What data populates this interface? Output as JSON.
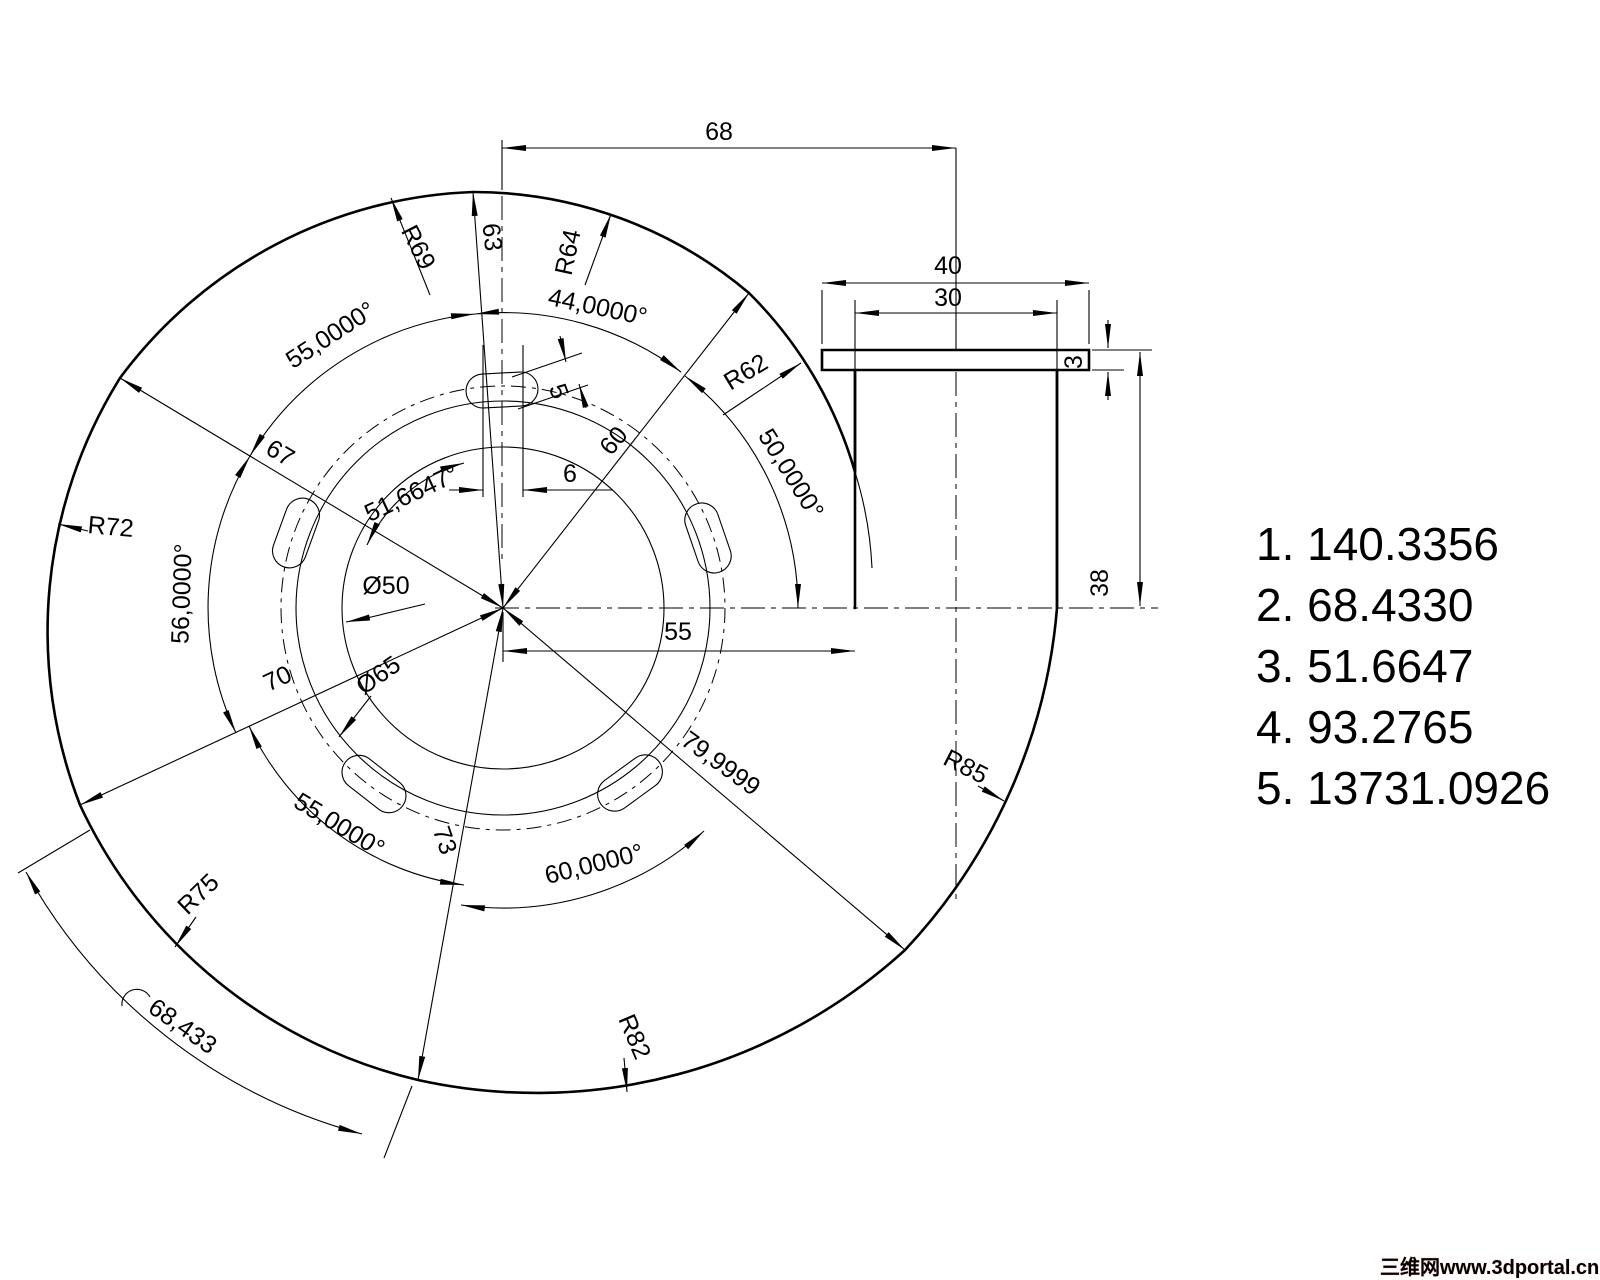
{
  "drawing_labels": {
    "radial": {
      "r63": "63",
      "r67": "67",
      "r60": "60",
      "r70": "70",
      "r73": "73",
      "r79": "79,9999",
      "arc68": "68,433"
    },
    "angles": {
      "top_left_55": "55,0000°",
      "top_44": "44,0000°",
      "top_right_50": "50,0000°",
      "left_56": "56,0000°",
      "inner_51": "51,6647°",
      "bottom_left_55": "55,0000°",
      "bottom_60": "60,0000°"
    },
    "radii": {
      "r69": "R69",
      "r64": "R64",
      "r62": "R62",
      "r72": "R72",
      "r75": "R75",
      "r82": "R82",
      "r85": "R85"
    },
    "diameters": {
      "d50": "Ø50",
      "d65": "Ø65"
    },
    "side_view": {
      "w68": "68",
      "w40": "40",
      "w30": "30",
      "t3": "3",
      "h38": "38",
      "c55": "55"
    },
    "slot": {
      "w6": "6",
      "h5": "5"
    }
  },
  "answers": {
    "items": [
      "1. 140.3356",
      "2. 68.4330",
      "3. 51.6647",
      "4. 93.2765",
      "5. 13731.0926"
    ]
  },
  "watermark": {
    "text": "三维网www.3dportal.cn",
    "color": "#e5342b"
  }
}
